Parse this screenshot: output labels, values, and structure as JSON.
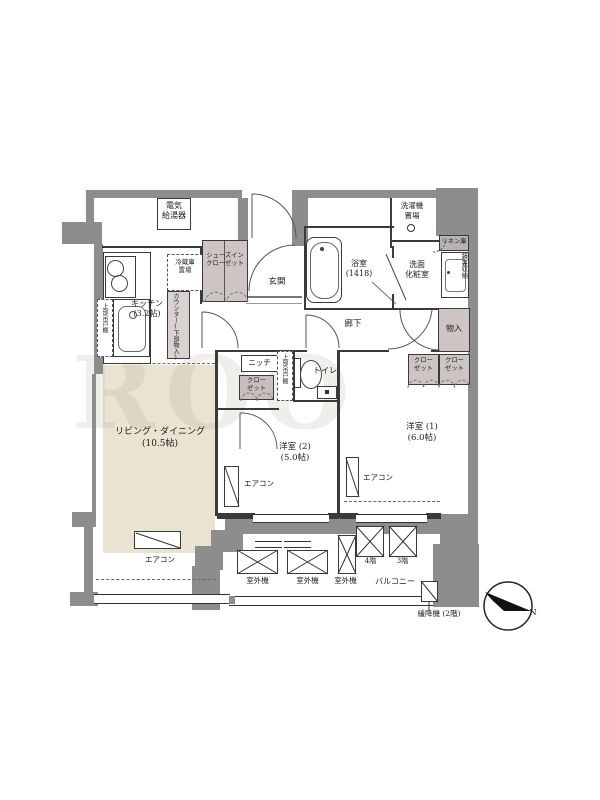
{
  "watermark": "ROO",
  "colors": {
    "wall": "#8d8d8d",
    "ld_floor": "#ebe3d2",
    "closet_fill": "#ccc5c3"
  },
  "labels": {
    "water_heater": [
      "電気",
      "給湯器"
    ],
    "fridge": [
      "冷蔵庫",
      "置場"
    ],
    "shoes_closet": [
      "シューズイン",
      "クローゼット"
    ],
    "entrance": "玄関",
    "bath": [
      "浴室",
      "(1418)"
    ],
    "washer": [
      "洗濯機",
      "置場"
    ],
    "powder_room": [
      "洗面",
      "化粧室"
    ],
    "linen": "リネン庫",
    "mirror_storage": "鏡裏収納",
    "storage": "物入",
    "corridor": "廊下",
    "kitchen": [
      "キッチン",
      "(3.2帖)"
    ],
    "counter": "カウンター(下部物入)",
    "upper_cabinet": "上部吊戸棚",
    "niche": "ニッチ",
    "closet_two_line": [
      "クロー",
      "ゼット"
    ],
    "toilet": "トイレ",
    "bedroom2": [
      "洋室 (2)",
      "(5.0帖)"
    ],
    "bedroom1": [
      "洋室 (1)",
      "(6.0帖)"
    ],
    "living_dining": [
      "リビング・ダイニング",
      "(10.5帖)"
    ],
    "aircon": "エアコン",
    "outdoor_unit": "室外機",
    "floor4": "4階",
    "floor3": "3階",
    "balcony": "バルコニー",
    "escape_device": "緩降機 (2階)",
    "compass_north": "N"
  }
}
